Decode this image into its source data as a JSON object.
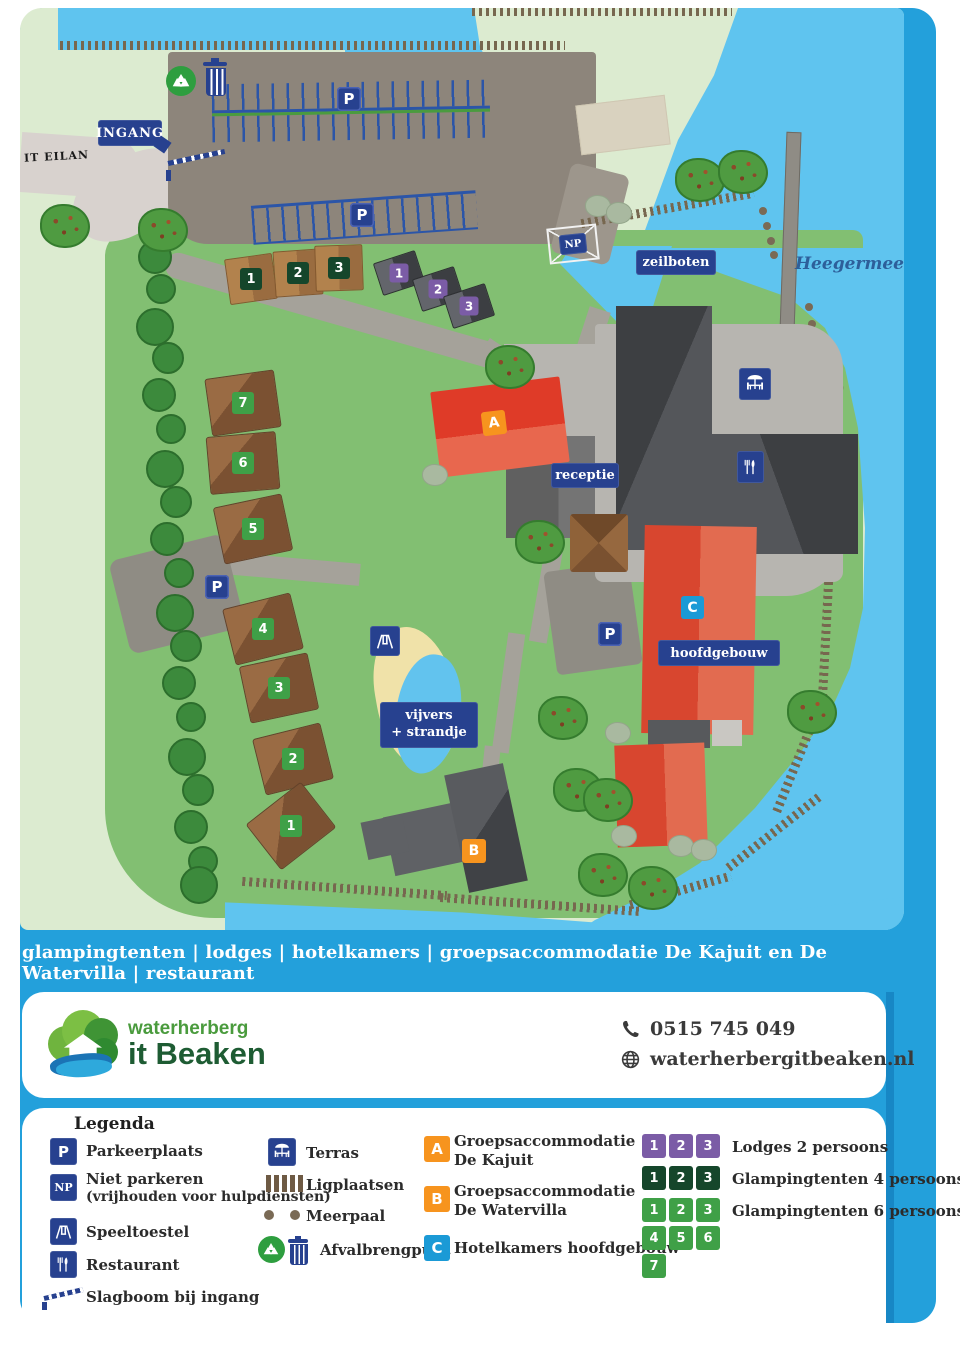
{
  "map": {
    "area_label": "Heegermeer",
    "road_label": "IT EILAN",
    "signs": {
      "ingang": "INGANG",
      "zeilboten": "zeilboten",
      "receptie": "receptie",
      "hoofdgebouw": "hoofdgebouw",
      "vijvers_line1": "vijvers",
      "vijvers_line2": "+ strandje",
      "np": "NP",
      "parking": "P"
    },
    "building_badges": {
      "a": "A",
      "b": "B",
      "c": "C"
    },
    "glampingtenten6_numbers": [
      "1",
      "2",
      "3",
      "4",
      "5",
      "6",
      "7"
    ],
    "glampingtenten4_numbers": [
      "1",
      "2",
      "3"
    ],
    "lodges2_numbers": [
      "1",
      "2",
      "3"
    ]
  },
  "tagline": "glampingtenten | lodges | hotelkamers | groepsaccommodatie De Kajuit en De Watervilla | restaurant",
  "brand": {
    "name_line1": "waterherberg",
    "name_line2": "it Beaken",
    "phone": "0515 745 049",
    "website": "waterherbergitbeaken.nl"
  },
  "legend": {
    "title": "Legenda",
    "p": "P",
    "np": "NP",
    "parkeerplaats": "Parkeerplaats",
    "niet_parkeren": "Niet parkeren",
    "niet_parkeren_sub": "(vrijhouden voor hulpdiensten)",
    "speeltoestel": "Speeltoestel",
    "restaurant": "Restaurant",
    "slagboom": "Slagboom bij ingang",
    "terras": "Terras",
    "ligplaatsen": "Ligplaatsen",
    "meerpaal": "Meerpaal",
    "afvalbrengpunt": "Afvalbrengpunt",
    "groeps_a_line1": "Groepsaccommodatie",
    "groeps_a_line2": "De Kajuit",
    "groeps_b_line1": "Groepsaccommodatie",
    "groeps_b_line2": "De Watervilla",
    "hotelkamers": "Hotelkamers hoofdgebouw",
    "lodges2": "Lodges 2 persoons",
    "glamping4": "Glampingtenten 4 persoons",
    "glamping6": "Glampingtenten 6 persoons"
  },
  "colors": {
    "frame_blue": "#23a0db",
    "water": "#5fc4ef",
    "camp_green": "#82bf72",
    "pale_land": "#dcebd0",
    "sign_navy": "#27418f",
    "badge_orange": "#f7941e",
    "badge_blue": "#1b9ad6",
    "badge_purple": "#7b5ca6",
    "badge_green": "#3fa047",
    "badge_darkgreen": "#15462b",
    "building_red": "#df4531"
  }
}
